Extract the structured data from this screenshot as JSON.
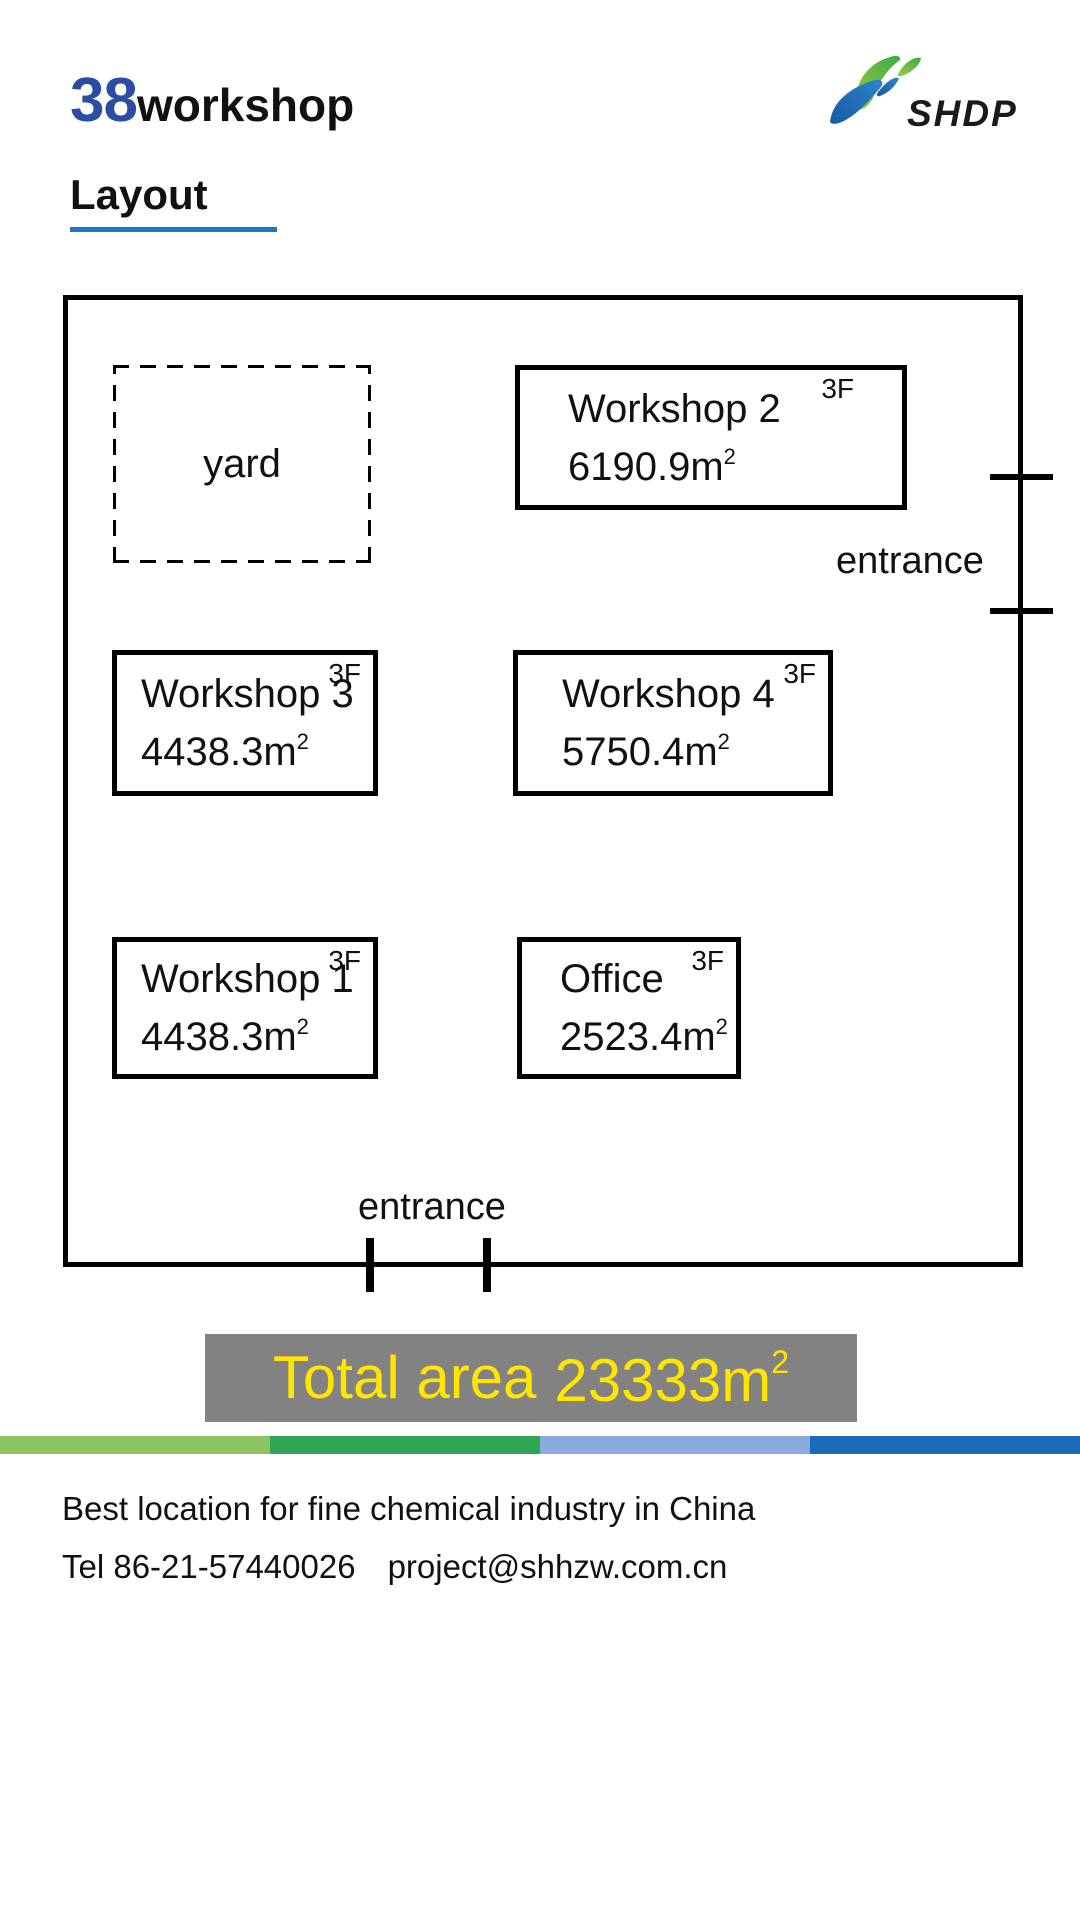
{
  "header": {
    "title_number": "38",
    "title_word": "workshop",
    "logo_text": "SHDP"
  },
  "section": {
    "heading": "Layout"
  },
  "plan": {
    "yard_label": "yard",
    "rooms": [
      {
        "label": "Workshop 2",
        "area": "6190.9",
        "unit_base": "m",
        "unit_exp": "2",
        "floor": "3F"
      },
      {
        "label": "Workshop 3",
        "area": "4438.3",
        "unit_base": "m",
        "unit_exp": "2",
        "floor": "3F"
      },
      {
        "label": "Workshop 4",
        "area": "5750.4",
        "unit_base": "m",
        "unit_exp": "2",
        "floor": "3F"
      },
      {
        "label": "Workshop 1",
        "area": "4438.3",
        "unit_base": "m",
        "unit_exp": "2",
        "floor": "3F"
      },
      {
        "label": "Office",
        "area": "2523.4",
        "unit_base": "m",
        "unit_exp": "2",
        "floor": "3F"
      }
    ],
    "entrance_right_label": "entrance",
    "entrance_bottom_label": "entrance"
  },
  "summary": {
    "label": "Total area",
    "value": "23333",
    "unit_base": "m",
    "unit_exp": "2",
    "background": "#828282",
    "text_color": "#FFE500"
  },
  "colors": {
    "title_number_blue": "#2B4EA2",
    "heading_underline_blue": "#2278BE",
    "stripe": [
      "#8CC45F",
      "#2FA651",
      "#8AACDC",
      "#1A6CB8"
    ],
    "logo_green_light": "#9ACD3E",
    "logo_green_dark": "#3CAB4A",
    "logo_blue_light": "#2E84C6",
    "logo_blue_dark": "#1759A5"
  },
  "footer": {
    "tagline": "Best location for fine chemical industry in China",
    "tel": "Tel 86-21-57440026",
    "email": "project@shhzw.com.cn"
  }
}
